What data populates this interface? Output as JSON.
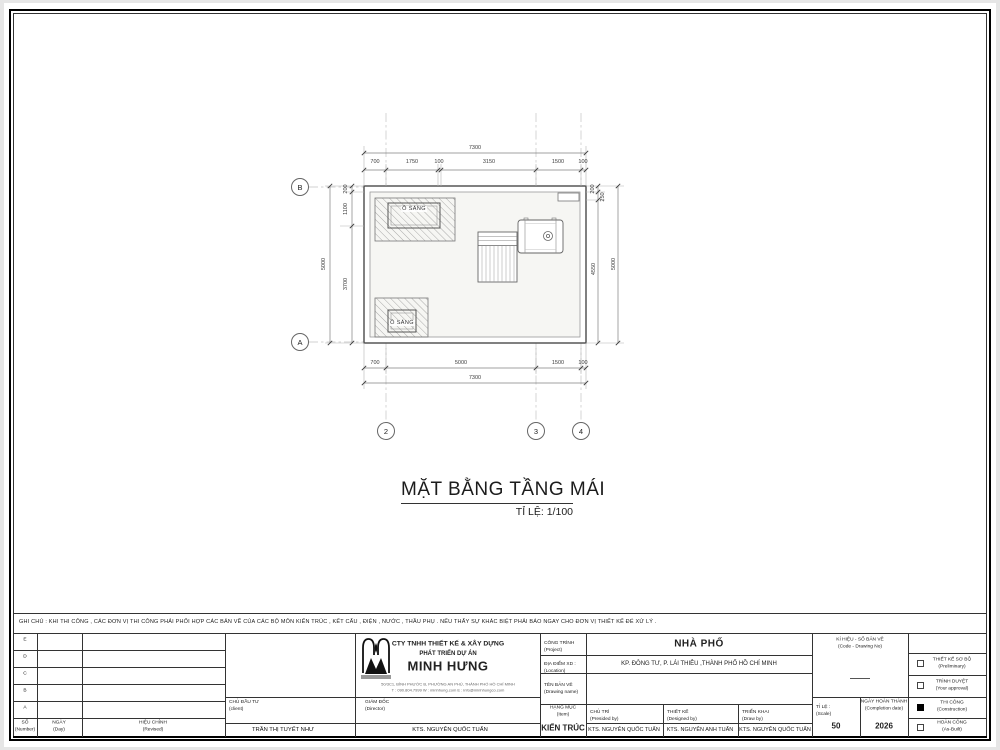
{
  "note": "GHI CHÚ : KHI THI CÔNG , CÁC ĐƠN VỊ THI CÔNG PHẢI PHỐI HỢP CÁC BẢN VẼ CỦA CÁC BỘ MÔN KIẾN TRÚC , KẾT CẤU , ĐIỆN , NƯỚC , THẦU PHỤ . NẾU THẤY SỰ KHÁC BIỆT PHẢI BÁO NGAY CHO ĐƠN VỊ THIẾT KẾ ĐỂ XỬ LÝ .",
  "plan": {
    "title": "MẶT BẰNG TẦNG MÁI",
    "scale_note": "TỈ LỆ: 1/100",
    "skylight1": "Ô SÁNG",
    "skylight2": "Ô SÁNG",
    "grid": {
      "b": "B",
      "a": "A",
      "c2": "2",
      "c3": "3",
      "c4": "4"
    },
    "dims": {
      "top_total": "7300",
      "top": [
        "700",
        "1750",
        "100",
        "3150",
        "1500",
        "100"
      ],
      "left_total": "5000",
      "left": [
        "200",
        "1100",
        "3700"
      ],
      "right_total": "5000",
      "right": [
        "200",
        "250",
        "4550"
      ],
      "bottom_total": "7300",
      "bottom": [
        "700",
        "5000",
        "1500",
        "100"
      ]
    }
  },
  "titleblock": {
    "revision": {
      "rows": [
        "E",
        "D",
        "C",
        "B",
        "A"
      ],
      "col1_vi": "SỐ",
      "col1_en": "(Number)",
      "col2_vi": "NGÀY",
      "col2_en": "(Day)",
      "col3_vi": "HIỆU CHỈNH",
      "col3_en": "(Revised)"
    },
    "client": {
      "label_vi": "CHỦ ĐẦU TƯ",
      "label_en": "(client)",
      "name": "TRẦN THỊ TUYẾT NHƯ"
    },
    "company": {
      "line1": "CTY TNHH THIẾT KẾ & XÂY DỰNG",
      "line2": "PHÁT TRIỂN DỰ ÁN",
      "name": "MINH HƯNG",
      "address": "50/3C1, BÌNH PHƯỚC B, PHƯỜNG AN PHÚ, THÀNH PHỐ HỒ CHÍ MINH",
      "contact": "T : 090.804.7999      W : minhhung.com      E : info@minhhungco.com"
    },
    "director": {
      "label_vi": "GIÁM ĐỐC",
      "label_en": "(Director)",
      "name": "KTS. NGUYỄN QUỐC TUẤN"
    },
    "project": {
      "label_vi": "CÔNG TRÌNH",
      "label_en": "(Project)",
      "value": "NHÀ PHỐ"
    },
    "location": {
      "label_vi": "ĐỊA ĐIỂM XD :",
      "label_en": "(Location)",
      "value": "KP. ĐÔNG TƯ, P. LÁI THIÊU ,THÀNH PHỐ HỒ CHÍ MINH"
    },
    "drawing_name": {
      "label_vi": "TÊN BẢN VẼ",
      "label_en": "(Drawing name)"
    },
    "item": {
      "label_vi": "HẠNG MỤC",
      "label_en": "(Item)",
      "value": "KIẾN TRÚC"
    },
    "presided": {
      "label_vi": "CHỦ TRÌ",
      "label_en": "(Presided by)",
      "name": "KTS. NGUYỄN QUỐC TUẤN"
    },
    "designed": {
      "label_vi": "THIẾT KẾ",
      "label_en": "(Designed by)",
      "name": "KTS. NGUYỄN ANH TUẤN"
    },
    "deployed": {
      "label_vi": "TRIỂN KHAI",
      "label_en": "(Draw by)",
      "name": "KTS. NGUYỄN QUỐC TUẤN"
    },
    "code": {
      "label_vi": "KÍ HIỆU - SỐ BẢN VẼ",
      "label_en": "(Code - Drawing No)"
    },
    "scale": {
      "label_vi": "TỈ LỆ :",
      "label_en": "(Scale)",
      "value": "50"
    },
    "date": {
      "label_vi": "NGÀY HOÀN THÀNH",
      "label_en": "(Completion date)",
      "value": "2026"
    },
    "stages": [
      {
        "label_vi": "THIẾT KẾ SƠ BỘ",
        "label_en": "(Preliminary)",
        "checked": false
      },
      {
        "label_vi": "TRÌNH DUYỆT",
        "label_en": "(Your approval)",
        "checked": false
      },
      {
        "label_vi": "THI CÔNG",
        "label_en": "(Construction)",
        "checked": true
      },
      {
        "label_vi": "HOÀN CÔNG",
        "label_en": "(As-Built)",
        "checked": false
      }
    ]
  }
}
